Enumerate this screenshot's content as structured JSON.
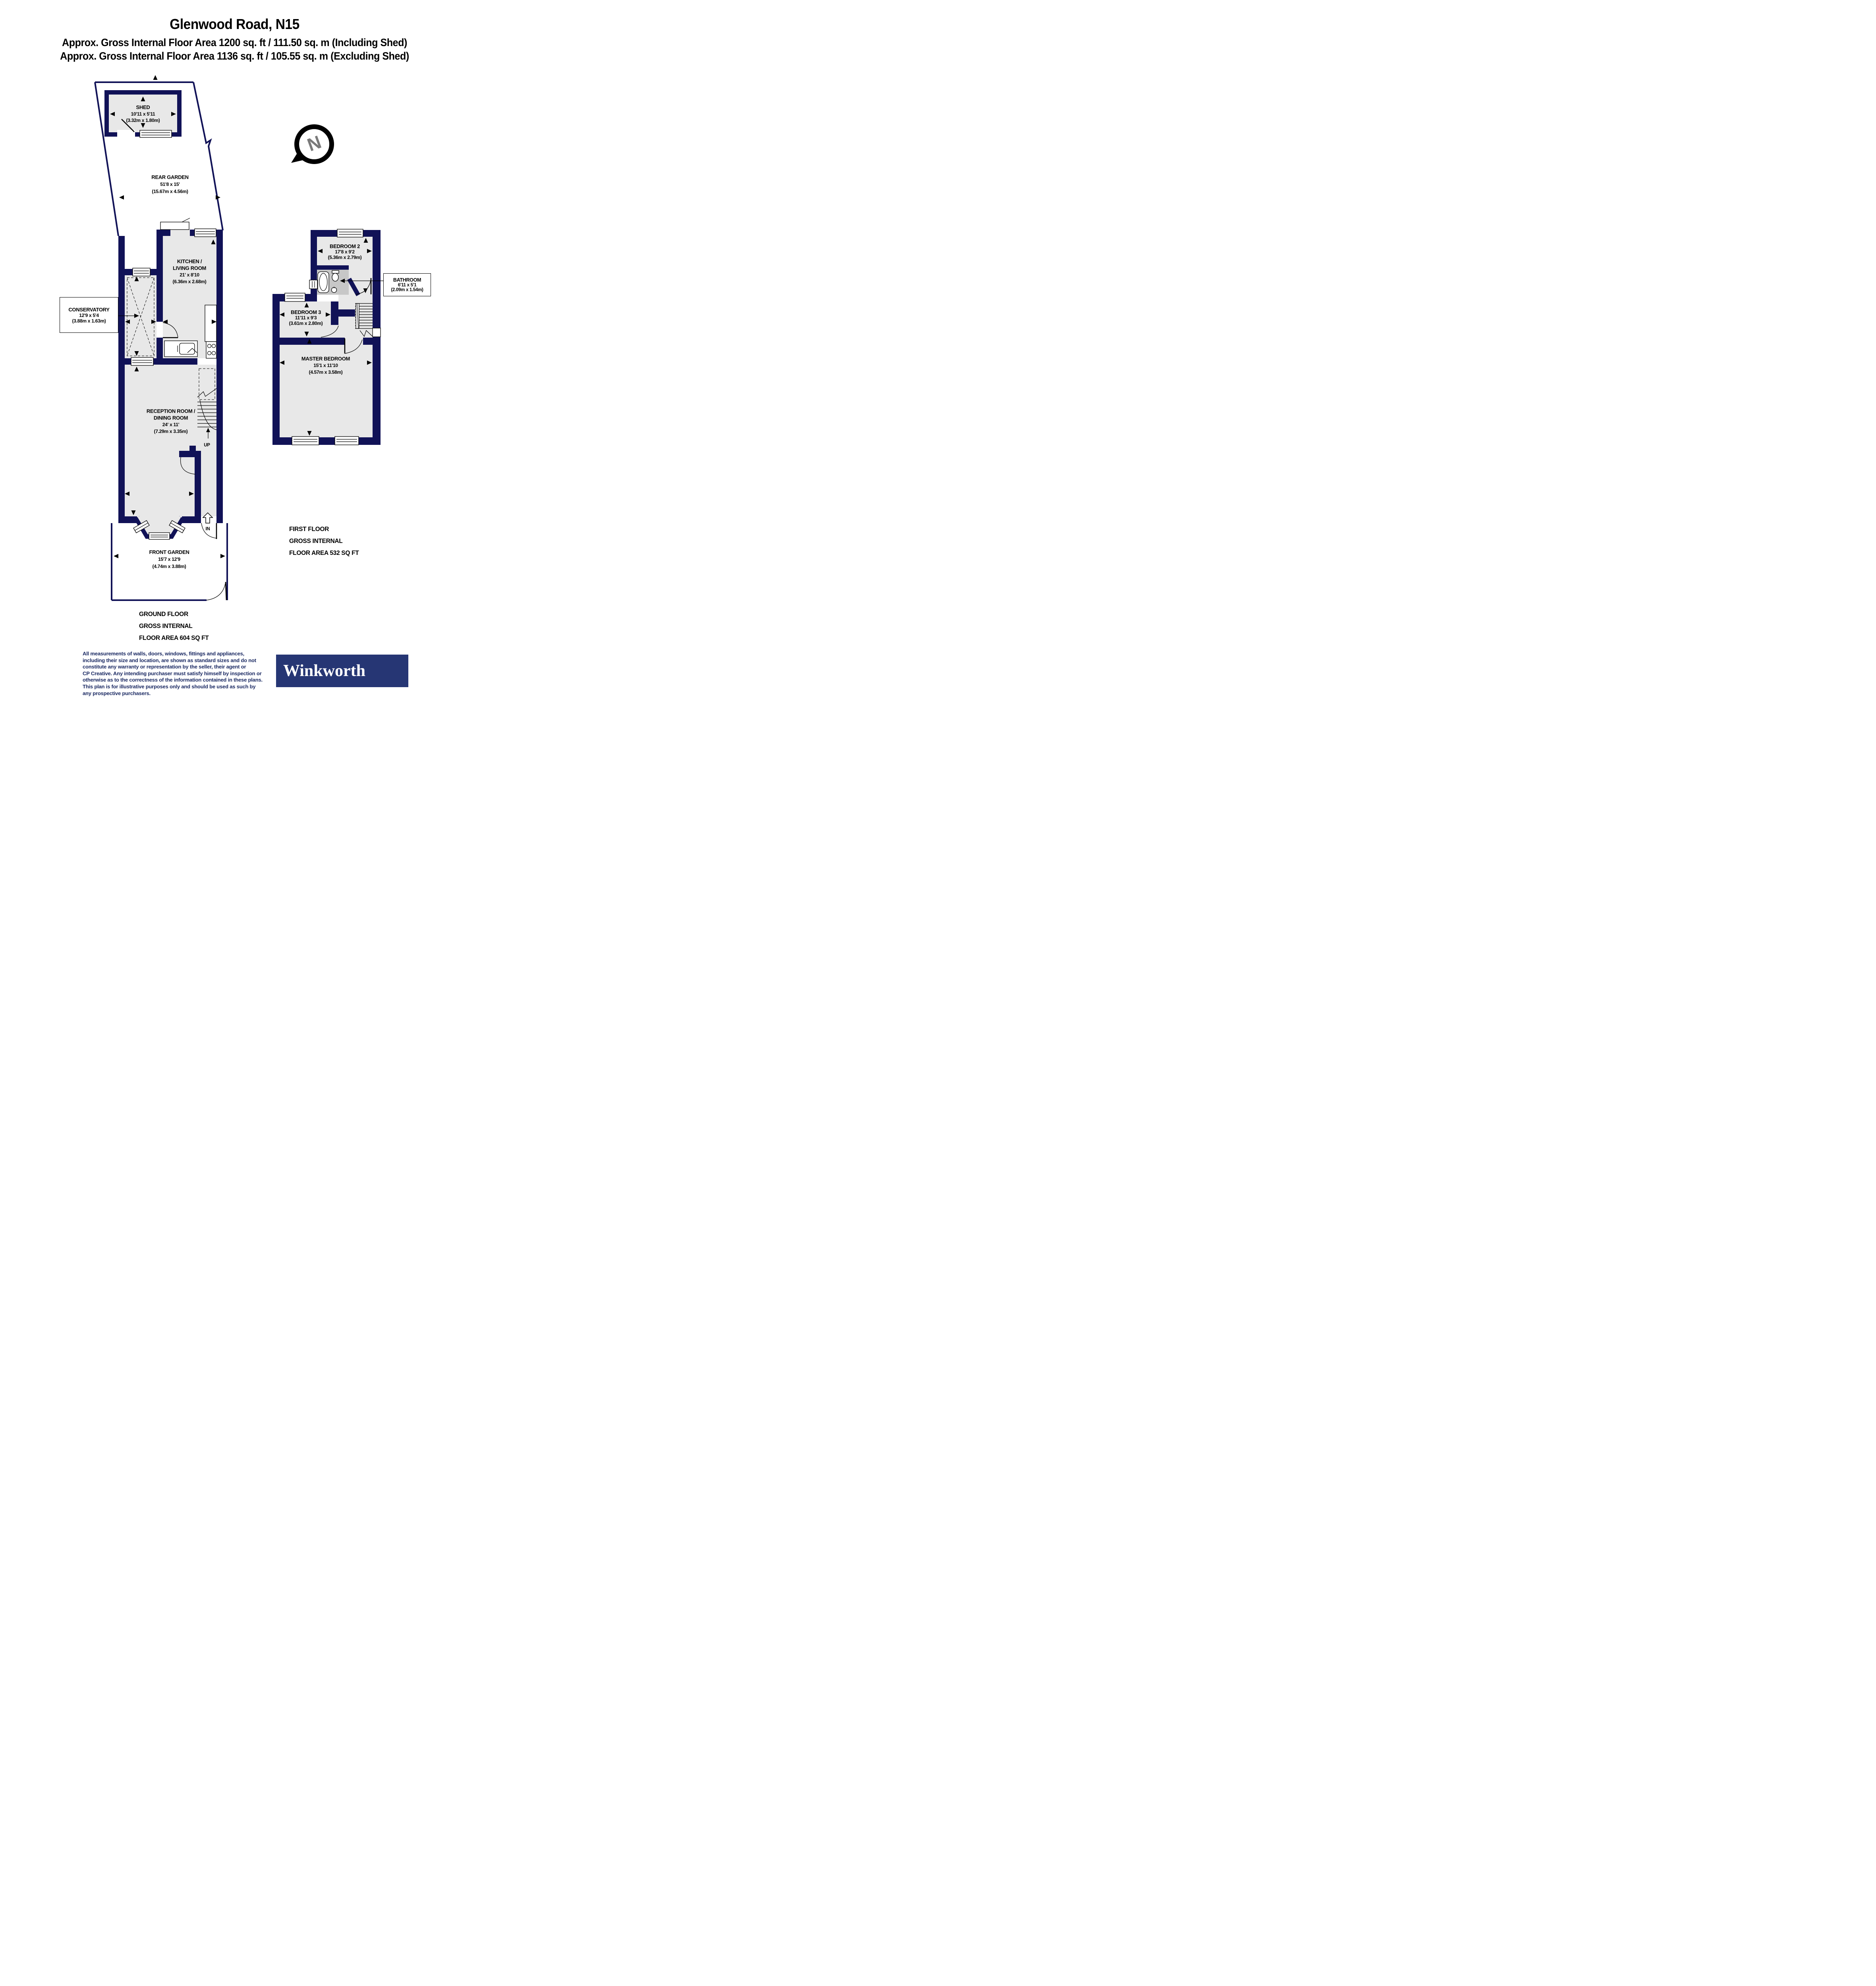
{
  "colors": {
    "wall": "#111257",
    "room": "#e8e8e8",
    "fixture": "#c7c7c7",
    "navy_text": "#1b2a63",
    "logo_bg": "#263674",
    "compass_n": "#7a7a7a"
  },
  "header": {
    "title": "Glenwood Road, N15",
    "line1": "Approx. Gross Internal Floor Area 1200 sq. ft / 111.50 sq. m (Including Shed)",
    "line2": "Approx. Gross Internal Floor Area 1136 sq. ft / 105.55 sq. m (Excluding Shed)"
  },
  "compass": {
    "label": "N"
  },
  "ground_floor": {
    "shed": {
      "name": "SHED",
      "imperial": "10'11 x 5'11",
      "metric": "(3.32m x 1.80m)"
    },
    "rear_garden": {
      "name": "REAR GARDEN",
      "imperial": "51'8 x 15'",
      "metric": "(15.67m x 4.56m)"
    },
    "conservatory": {
      "name": "CONSERVATORY",
      "imperial": "12'9 x 5'4",
      "metric": "(3.88m x 1.63m)"
    },
    "kitchen": {
      "name1": "KITCHEN /",
      "name2": "LIVING ROOM",
      "imperial": "21' x 8'10",
      "metric": "(6.36m x 2.68m)"
    },
    "reception": {
      "name1": "RECEPTION ROOM /",
      "name2": "DINING ROOM",
      "imperial": "24' x 11'",
      "metric": "(7.29m x 3.35m)"
    },
    "front_garden": {
      "name": "FRONT GARDEN",
      "imperial": "15'7 x 12'9",
      "metric": "(4.74m x 3.88m)"
    },
    "up_label": "UP",
    "in_label": "IN",
    "caption": {
      "line1": "GROUND FLOOR",
      "line2": "GROSS INTERNAL",
      "line3": "FLOOR AREA 604 SQ FT"
    }
  },
  "first_floor": {
    "bedroom2": {
      "name": "BEDROOM 2",
      "imperial": "17'8 x 9'2",
      "metric": "(5.36m x 2.79m)"
    },
    "bathroom": {
      "name": "BATHROOM",
      "imperial": "6'11 x 5'1",
      "metric": "(2.09m x 1.54m)"
    },
    "bedroom3": {
      "name": "BEDROOM 3",
      "imperial": "11'11 x 9'3",
      "metric": "(3.61m x 2.80m)"
    },
    "master_bedroom": {
      "name": "MASTER BEDROOM",
      "imperial": "15'1 x 11'10",
      "metric": "(4.57m x 3.58m)"
    },
    "caption": {
      "line1": "FIRST FLOOR",
      "line2": "GROSS INTERNAL",
      "line3": "FLOOR AREA 532 SQ FT"
    }
  },
  "disclaimer": {
    "lines": [
      "All measurements of walls, doors, windows, fittings and appliances,",
      "including their size and location, are shown as standard sizes and do not",
      "constitute any warranty or representation by the seller, their agent or",
      "CP Creative. Any intending purchaser must satisfy himself by inspection or",
      "otherwise as to the correctness of the information contained in these plans.",
      "This plan is for illustrative purposes only and should be used as such by",
      "any prospective purchasers."
    ]
  },
  "logo": {
    "text": "Winkworth"
  }
}
